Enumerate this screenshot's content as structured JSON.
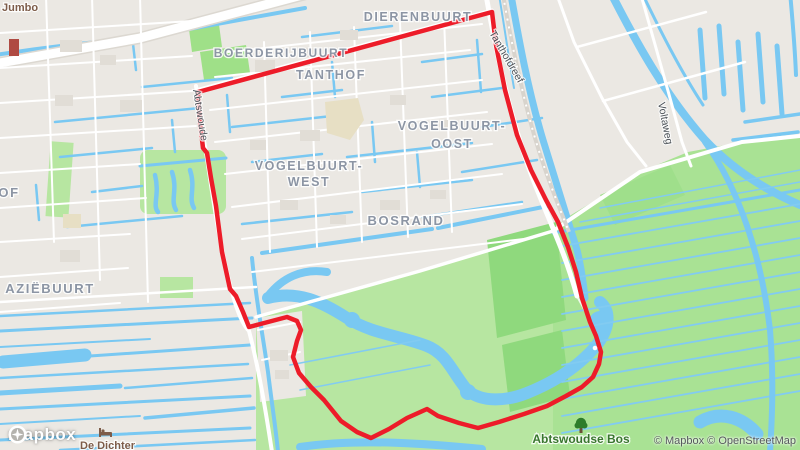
{
  "map": {
    "attribution": "© Mapbox © OpenStreetMap",
    "logo_text": "mapbox",
    "districts": [
      {
        "text": "DIERENBUURT"
      },
      {
        "text": "BOERDERIJBUURT"
      },
      {
        "text": "TANTHOF"
      },
      {
        "text": "VOGELBUURT-"
      },
      {
        "text": "OOST"
      },
      {
        "text": "VOGELBUURT-"
      },
      {
        "text": "WEST"
      },
      {
        "text": "BOSRAND"
      },
      {
        "text": "AZIËBUURT"
      },
      {
        "text": "OF"
      }
    ],
    "streets": [
      {
        "text": "Abtswoude"
      },
      {
        "text": "Tanthofdreef"
      },
      {
        "text": "Voltaweg"
      }
    ],
    "pois": [
      {
        "text": "Jumbo",
        "type": "shop"
      },
      {
        "text": "De Dichter",
        "type": "lodging"
      },
      {
        "text": "Abtswoudse Bos",
        "type": "park"
      }
    ],
    "icons": {
      "park_marker": "tree-icon",
      "lodging_marker": "bed-icon",
      "logo_mark": "mapbox-logo-icon"
    },
    "colors": {
      "land": "#EBE8E3",
      "water": "#79C8F2",
      "park": "#B7E6A1",
      "field": "#A9E294",
      "forest": "#8FD97D",
      "road": "#FFFFFF",
      "route": "#ED1C29",
      "district_label": "#8C95A4",
      "street_label": "#4C5258",
      "poi_shop_label": "#7D5C49",
      "poi_park_label": "#39762E",
      "attribution_text": "#55585C"
    },
    "route": {
      "color": "#ED1C29",
      "endpoint": [
        595,
        348
      ],
      "points": [
        [
          198,
          92
        ],
        [
          492,
          12
        ],
        [
          496,
          45
        ],
        [
          505,
          90
        ],
        [
          517,
          135
        ],
        [
          531,
          170
        ],
        [
          546,
          200
        ],
        [
          558,
          222
        ],
        [
          568,
          247
        ],
        [
          576,
          272
        ],
        [
          582,
          298
        ],
        [
          590,
          322
        ],
        [
          596,
          336
        ],
        [
          601,
          352
        ],
        [
          599,
          364
        ],
        [
          593,
          377
        ],
        [
          582,
          387
        ],
        [
          566,
          396
        ],
        [
          547,
          406
        ],
        [
          524,
          414
        ],
        [
          499,
          422
        ],
        [
          478,
          428
        ],
        [
          459,
          423
        ],
        [
          438,
          416
        ],
        [
          427,
          409
        ],
        [
          407,
          418
        ],
        [
          389,
          429
        ],
        [
          371,
          438
        ],
        [
          357,
          432
        ],
        [
          341,
          421
        ],
        [
          324,
          400
        ],
        [
          311,
          387
        ],
        [
          299,
          373
        ],
        [
          293,
          357
        ],
        [
          297,
          341
        ],
        [
          301,
          330
        ],
        [
          297,
          321
        ],
        [
          287,
          317
        ],
        [
          268,
          322
        ],
        [
          249,
          327
        ],
        [
          243,
          312
        ],
        [
          236,
          296
        ],
        [
          230,
          289
        ],
        [
          222,
          252
        ],
        [
          216,
          206
        ],
        [
          211,
          178
        ],
        [
          207,
          153
        ],
        [
          203,
          148
        ],
        [
          200,
          122
        ],
        [
          198,
          92
        ]
      ]
    }
  }
}
